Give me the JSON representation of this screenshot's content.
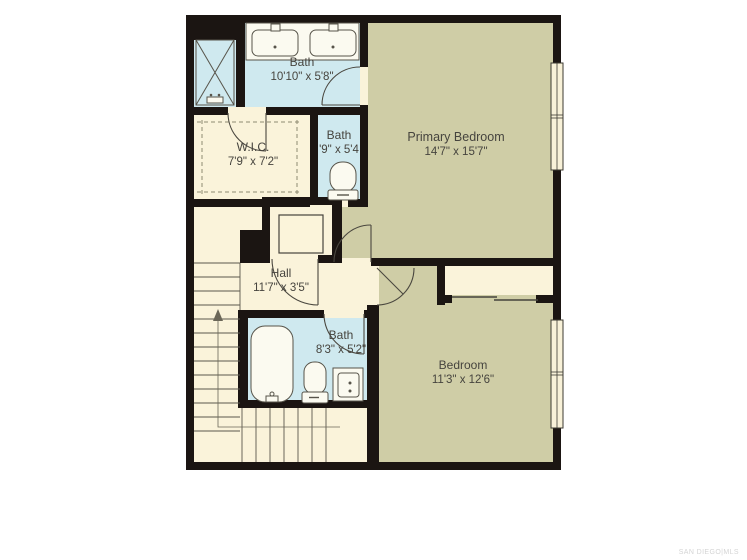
{
  "watermark": "SAN DIEGO|MLS",
  "rooms": {
    "primary_bath": {
      "label": "Bath",
      "dims": "10'10\" x 5'8\""
    },
    "wic": {
      "label": "W.I.C.",
      "dims": "7'9\" x 7'2\""
    },
    "small_bath": {
      "label": "Bath",
      "dims": "'9\" x 5'4"
    },
    "primary_bedroom": {
      "label": "Primary Bedroom",
      "dims": "14'7\" x 15'7\""
    },
    "hall": {
      "label": "Hall",
      "dims": "11'7\" x 3'5\""
    },
    "hall_bath": {
      "label": "Bath",
      "dims": "8'3\" x 5'2\""
    },
    "bedroom": {
      "label": "Bedroom",
      "dims": "11'3\" x 12'6\""
    }
  },
  "colors": {
    "wall": "#1b1512",
    "bath_floor": "#cfe9ef",
    "bedroom_floor": "#cfcda6",
    "floor": "#faf3da",
    "fixture_fill": "#fbfaf0",
    "line": "#4a473f"
  }
}
